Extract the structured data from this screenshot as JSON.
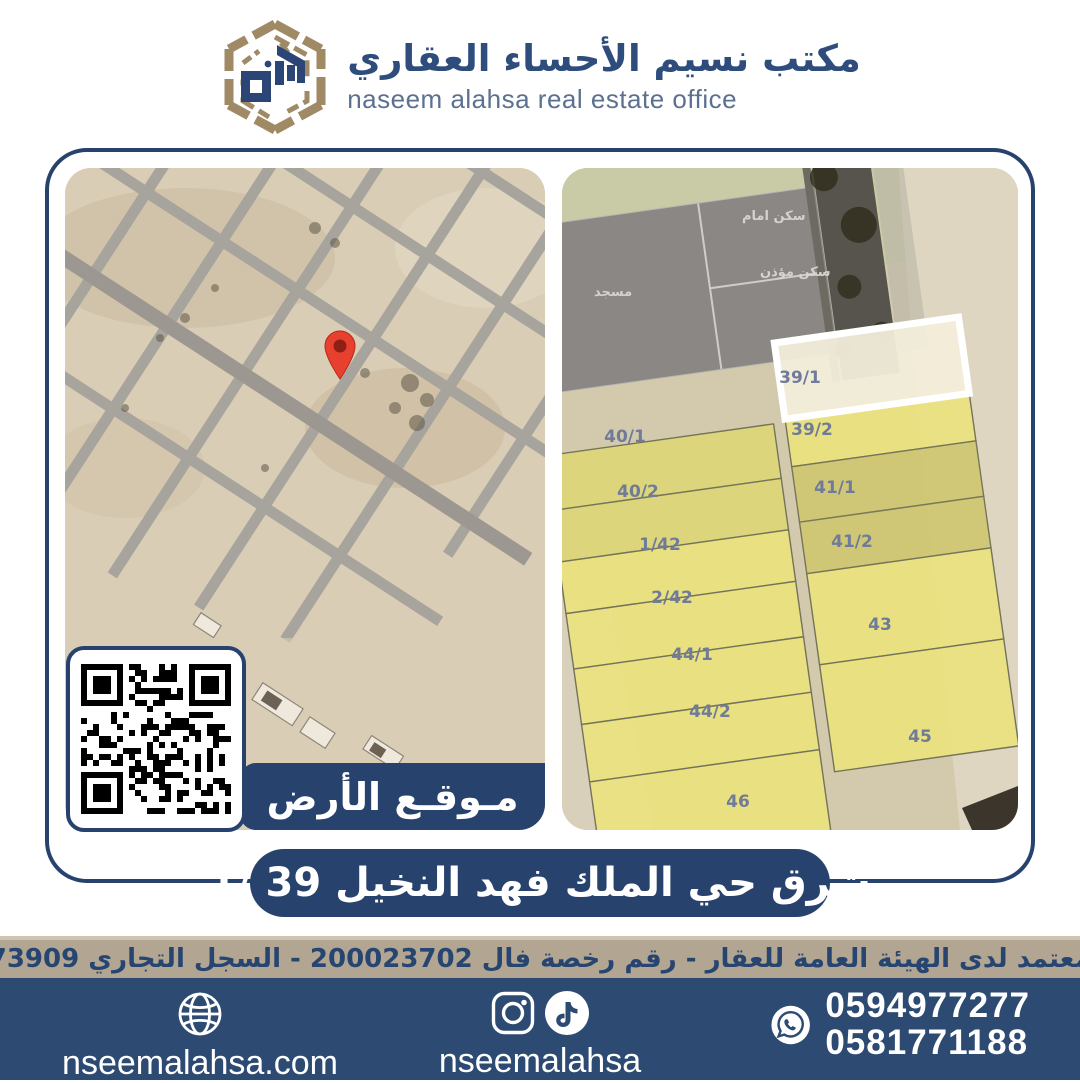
{
  "brand": {
    "title_ar": "مكتب نسيم الأحساء العقاري",
    "subtitle_en": "naseem alahsa real estate office"
  },
  "location_banner": {
    "label": "مـوقـع الأرض"
  },
  "listing_banner": {
    "text": "شرق حي الملك فهد النخيل  39 /1"
  },
  "license_bar": {
    "text": "مسوق معتمد لدى الهيئة العامة للعقار - رقم رخصة فال 200023702 - السجل التجاري 2250373909"
  },
  "footer": {
    "website": "nseemalahsa.com",
    "social_handle": "nseemalahsa",
    "phones": [
      "0594977277",
      "0581771188"
    ]
  },
  "colors": {
    "navy": "#27426d",
    "footer_navy": "#2c4a72",
    "tan_strip": "#b2a693",
    "logo_gold": "#9f8a65",
    "logo_blue": "#2b4576",
    "parcel_yellow": "#eae37b",
    "parcel_highlight_fill": "#f2edda",
    "parcel_label": "#6f7b99",
    "pin_red": "#e8402f"
  },
  "right_map": {
    "area_labels": [
      {
        "text": "مسجد",
        "x": 32,
        "y": 128
      },
      {
        "text": "سكن امام",
        "x": 180,
        "y": 52
      },
      {
        "text": "سكن مؤذن",
        "x": 198,
        "y": 108
      }
    ],
    "parcels": [
      {
        "label": "40/1",
        "col": "left",
        "y0": 255,
        "y1": 310,
        "lx": 63,
        "ly": 268,
        "highlighted": false
      },
      {
        "label": "40/2",
        "col": "left",
        "y0": 310,
        "y1": 362,
        "lx": 76,
        "ly": 323,
        "highlighted": false
      },
      {
        "label": "1/42",
        "col": "left",
        "y0": 362,
        "y1": 414,
        "lx": 98,
        "ly": 376,
        "highlighted": false
      },
      {
        "label": "2/42",
        "col": "left",
        "y0": 414,
        "y1": 470,
        "lx": 110,
        "ly": 429,
        "highlighted": false
      },
      {
        "label": "44/1",
        "col": "left",
        "y0": 470,
        "y1": 526,
        "lx": 130,
        "ly": 486,
        "highlighted": false
      },
      {
        "label": "44/2",
        "col": "left",
        "y0": 526,
        "y1": 584,
        "lx": 148,
        "ly": 543,
        "highlighted": false
      },
      {
        "label": "46",
        "col": "left",
        "y0": 584,
        "y1": 678,
        "lx": 176,
        "ly": 633,
        "highlighted": false
      },
      {
        "label": "39/2",
        "col": "right",
        "y0": 252,
        "y1": 300,
        "lx": 250,
        "ly": 261,
        "highlighted": false
      },
      {
        "label": "41/1",
        "col": "right",
        "y0": 300,
        "y1": 356,
        "lx": 273,
        "ly": 319,
        "highlighted": false
      },
      {
        "label": "41/2",
        "col": "right",
        "y0": 356,
        "y1": 408,
        "lx": 290,
        "ly": 373,
        "highlighted": false
      },
      {
        "label": "43",
        "col": "right",
        "y0": 408,
        "y1": 500,
        "lx": 318,
        "ly": 456,
        "highlighted": false
      },
      {
        "label": "45",
        "col": "right",
        "y0": 500,
        "y1": 608,
        "lx": 358,
        "ly": 568,
        "highlighted": false
      },
      {
        "label": "39/1",
        "col": "right",
        "y0": 175,
        "y1": 252,
        "lx": 238,
        "ly": 209,
        "highlighted": true
      }
    ]
  }
}
